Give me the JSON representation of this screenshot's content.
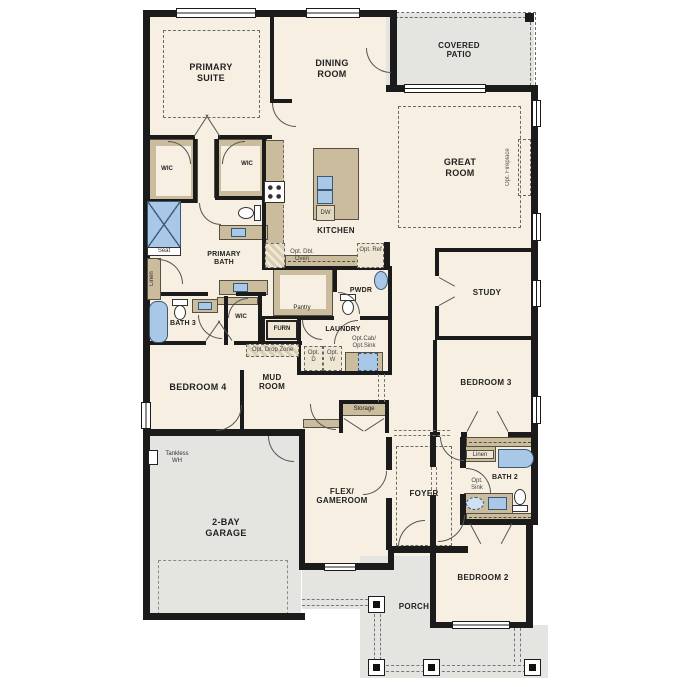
{
  "colors": {
    "wall": "#1b1b1b",
    "floor": "#f7efe2",
    "cabinet_tan": "#cbbc9d",
    "fixture_blue": "#a9c8e8",
    "concrete_gray": "#e4e4e1"
  },
  "rooms": {
    "primary_suite": "PRIMARY SUITE",
    "dining_room": "DINING ROOM",
    "covered_patio": "COVERED PATIO",
    "great_room": "GREAT ROOM",
    "kitchen": "KITCHEN",
    "study": "STUDY",
    "primary_bath": "PRIMARY BATH",
    "bath_3": "BATH 3",
    "bath_2": "BATH 2",
    "pwdr": "PWDR",
    "laundry": "LAUNDRY",
    "pantry": "Pantry",
    "mud_room": "MUD ROOM",
    "bedroom_4": "BEDROOM 4",
    "bedroom_3": "BEDROOM 3",
    "bedroom_2": "BEDROOM 2",
    "flex_gameroom": "FLEX/ GAMEROOM",
    "foyer": "FOYER",
    "garage": "2-BAY GARAGE",
    "porch": "PORCH",
    "storage": "Storage",
    "wic_primary_left": "WIC",
    "wic_primary_right": "WIC",
    "wic_bed4": "WIC"
  },
  "annotations": {
    "opt_fireplace": "Opt. Fireplace",
    "opt_dbl_oven": "Opt. Dbl. Oven",
    "opt_ref": "Opt. Ref",
    "opt_drop_zone": "Opt. Drop Zone",
    "opt_d": "Opt. D",
    "opt_w": "Opt. W",
    "opt_cab_sink": "Opt.Cab/ Opt.Sink",
    "opt_sink": "Opt. Sink",
    "dw": "DW",
    "furn": "FURN",
    "seat": "Seat",
    "linen_primary": "Linen",
    "linen_bath2": "Linen",
    "tankless_wh": "Tankless WH"
  }
}
